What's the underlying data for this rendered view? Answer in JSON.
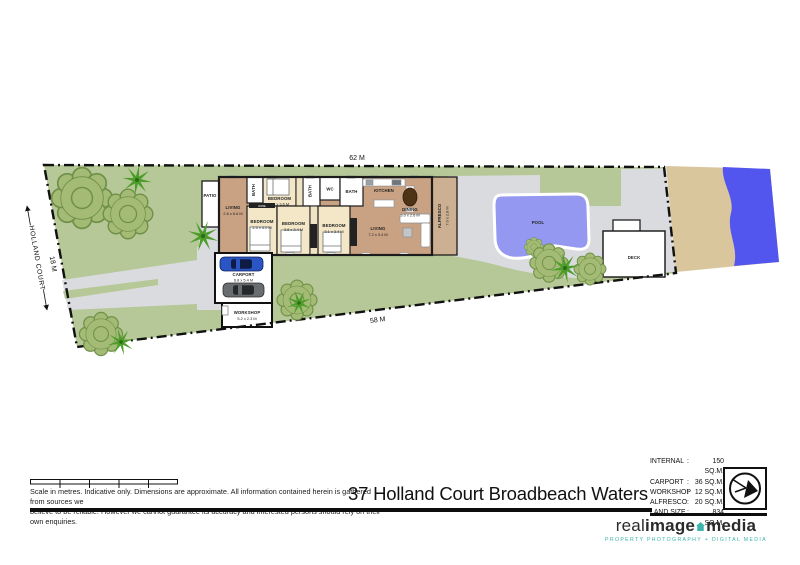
{
  "plan": {
    "street": "HOLLAND COURT",
    "boundary_top": "62 M",
    "boundary_bottom": "58 M",
    "boundary_left": "18 M",
    "rooms": {
      "patio": {
        "name": "PATIO"
      },
      "living1": {
        "name": "LIVING",
        "size": "2.6 x 6.6 M"
      },
      "bath1": {
        "name": "BATH"
      },
      "bedroom1": {
        "name": "BEDROOM",
        "size": "2.4 x 3.6 M"
      },
      "bath2": {
        "name": "BATH"
      },
      "wc": {
        "name": "WC"
      },
      "bath3": {
        "name": "BATH"
      },
      "kitchen": {
        "name": "KITCHEN"
      },
      "dining": {
        "name": "DINING",
        "size": "3.0 x 2.6 M"
      },
      "bedroom2": {
        "name": "BEDROOM",
        "size": "2.5 x 4.0 M"
      },
      "bedroom3": {
        "name": "BEDROOM",
        "size": "3.8 x 3.4 M"
      },
      "bedroom4": {
        "name": "BEDROOM",
        "size": "3.1 x 3.4 M"
      },
      "living2": {
        "name": "LIVING",
        "size": "7.2 x 3.4 M"
      },
      "alfresco": {
        "name": "ALFRESCO",
        "size": "7.0 x 2.8 M"
      },
      "robe": {
        "name": "ROBE"
      },
      "carport": {
        "name": "CARPORT",
        "size": "6.8 x 5.4 M"
      },
      "workshop": {
        "name": "WORKSHOP",
        "size": "5.2 x 2.3 M"
      },
      "pool": {
        "name": "POOL"
      },
      "deck": {
        "name": "DECK"
      }
    }
  },
  "footer": {
    "disclaimer_line1": "Scale in metres.  Indicative only.  Dimensions are approximate.  All information contained herein is gathered from sources we",
    "disclaimer_line2": "believe to be reliable.  However we cannot guarantee its accuracy and interested persons should rely on their own enquiries.",
    "title": "37 Holland Court Broadbeach Waters",
    "areas": [
      {
        "label": "INTERNAL",
        "value": "150 SQ.M."
      },
      {
        "label": "CARPORT",
        "value": "36 SQ.M."
      },
      {
        "label": "WORKSHOP",
        "value": "12 SQ.M."
      },
      {
        "label": "ALFRESCO",
        "value": "20 SQ.M."
      },
      {
        "label": "LAND SIZE",
        "value": "834 SQ.M."
      }
    ],
    "logo": {
      "word1": "real",
      "word2": "image",
      "word3": "media",
      "tagline": "PROPERTY PHOTOGRAPHY + DIGITAL MEDIA"
    }
  },
  "colors": {
    "lawn": "#b6c897",
    "tree": "#a3bb74",
    "palm": "#4d9d2b",
    "concrete": "#d9dbde",
    "floor_main": "#c9a283",
    "floor_bedroom": "#f3e7c8",
    "alfresco": "#cdb092",
    "pool": "#9598f0",
    "water": "#5356ee",
    "sand": "#d9c69c",
    "accent_teal": "#3db5ab",
    "line": "#111111"
  }
}
